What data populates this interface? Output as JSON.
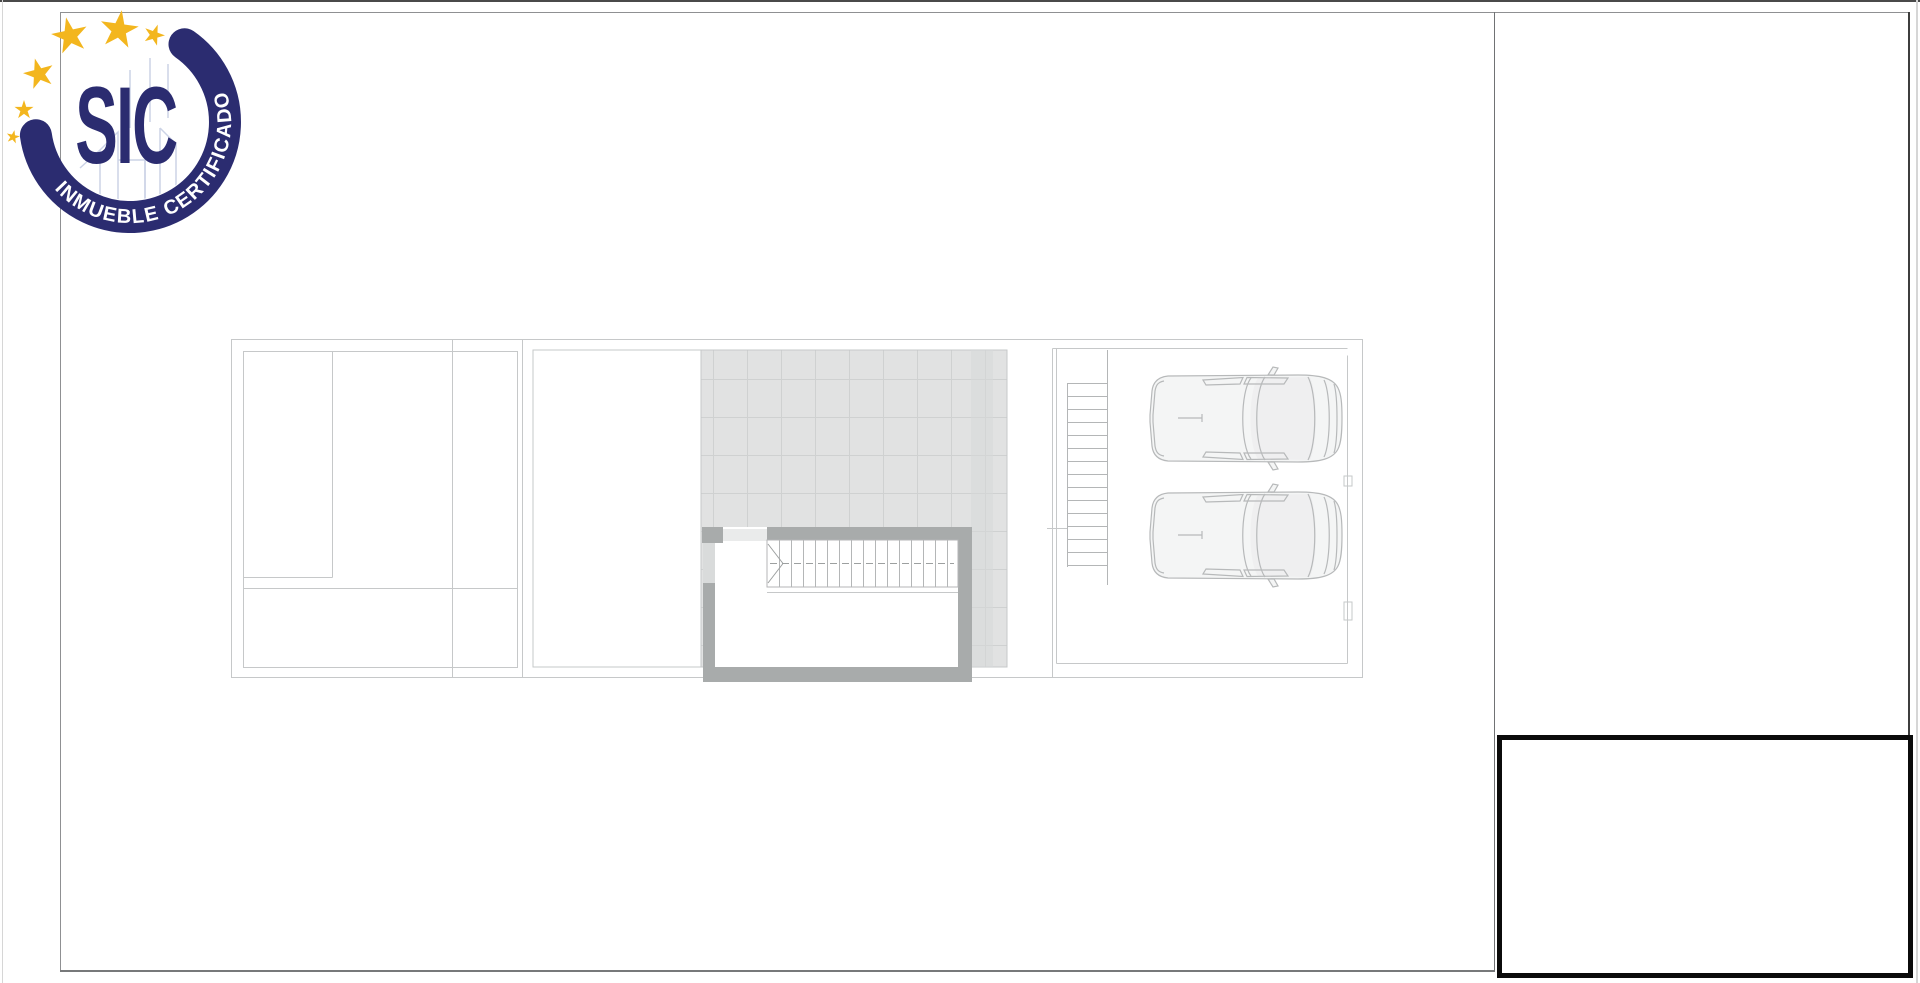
{
  "page": {
    "background": "#ffffff"
  },
  "logo": {
    "brand": "SIC",
    "tagline": "INMUEBLE CERTIFICADO",
    "star_count": 6
  },
  "floor_plan": {
    "type": "architectural-roof-plan",
    "stair_tread_count": 16,
    "ladder_rung_count": 15,
    "car_count": 2
  },
  "title_block": {
    "content": ""
  },
  "colors": {
    "page-bg": "#ffffff",
    "navy": "#2b2c70",
    "star-gold": "#f3b61e",
    "sketch-blue": "#ccd3e6",
    "top-edge": "#4a4a4a",
    "frame-line": "#8f9092",
    "frame-bottom": "#77797a",
    "divider-line": "#707274",
    "frame-right": "#3d3d3d",
    "page-edge": "#d6d6d6",
    "plan-line": "#c6c8c9",
    "tile-fill": "#e1e2e2",
    "tile-grid": "#cfd1d1",
    "tile-strip": "#d7d9d9",
    "pebble": "#c4c6c7",
    "wall-gray": "#a8abab",
    "door-gray": "#d9dbdb",
    "landing-gray": "#eaebeb",
    "stair-line": "#b4b6b7",
    "dash-line": "#9da0a0",
    "car-line": "#b7b9ba",
    "car-body": "#f4f5f5",
    "car-cabin": "#ededee",
    "title-border": "#0b0b0b"
  }
}
